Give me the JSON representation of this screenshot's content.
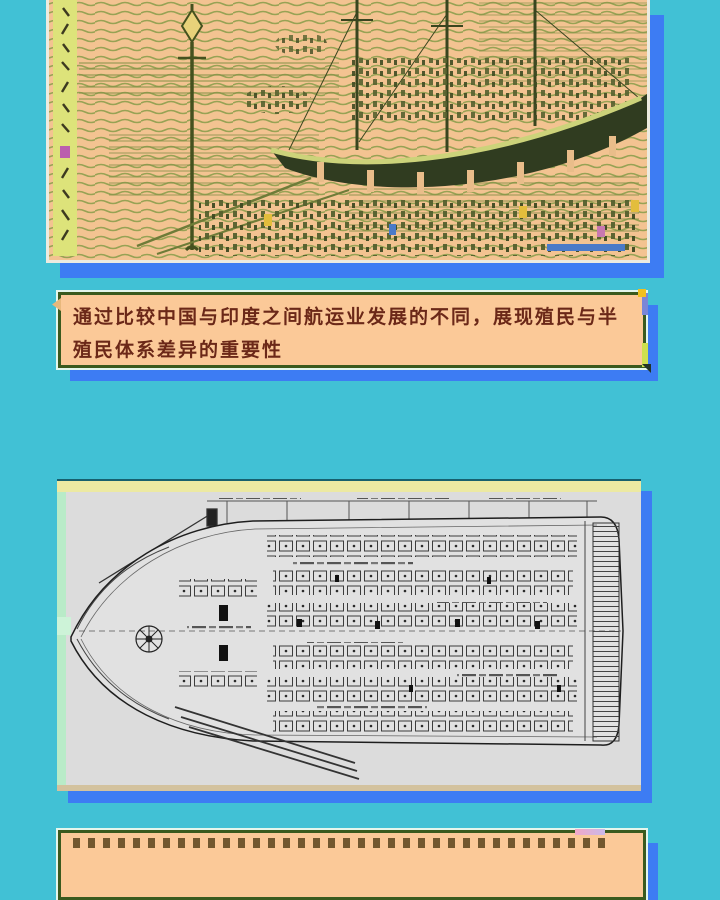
{
  "page": {
    "background_color": "#41c1d5",
    "shadow_color": "#3d7cf3"
  },
  "top_image": {
    "name": "woodblock-print-harbor-steamship",
    "description": "Japanese woodblock print: steamship with dark hull at a crowded harbor, lamppost at left, vertical calligraphy strip on left edge",
    "palette": {
      "paper": "#f3c391",
      "ink": "#97a254",
      "hull": "#303c20",
      "calligraphy_strip": "#dde37a"
    }
  },
  "caption_top": {
    "text": "通过比较中国与印度之间航运业发展的不同，展现殖民与半殖民体系差异的重要性",
    "background_color": "#fbc998",
    "text_color": "#6b2818",
    "border_color": "#3a5a1e"
  },
  "plan_image": {
    "name": "ship-deck-plan-drawing",
    "description": "Black-and-white technical deck plan of a steamship, bow pointing left, dense cabin grid and annotations",
    "palette": {
      "paper": "#dcdcdc",
      "ink": "#2a2a2a",
      "top_band": "#ece9a2",
      "left_band": "#b9ebc8"
    }
  },
  "caption_bottom": {
    "background_color": "#fbc998",
    "border_color": "#3a5a1e"
  }
}
